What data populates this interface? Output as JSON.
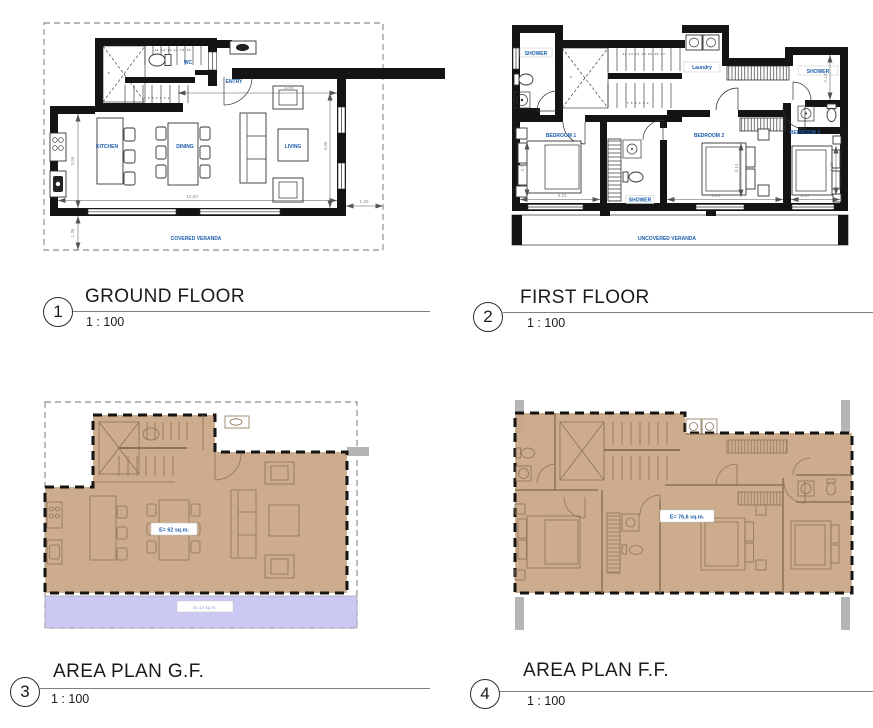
{
  "colors": {
    "label_blue": "#1A5DAB",
    "dim_gray": "#8C8C8C",
    "area_tan": "#C9A584",
    "veranda_lavender": "#CBC9F4",
    "column_gray": "#B5B5B5",
    "furniture_brown": "#8F7355"
  },
  "titles": [
    {
      "number": "1",
      "name": "GROUND FLOOR",
      "scale": "1 : 100"
    },
    {
      "number": "2",
      "name": "FIRST FLOOR",
      "scale": "1 : 100"
    },
    {
      "number": "3",
      "name": "AREA PLAN G.F.",
      "scale": "1 : 100"
    },
    {
      "number": "4",
      "name": "AREA PLAN F.F.",
      "scale": "1 : 100"
    }
  ],
  "viewports": {
    "ground_floor": {
      "labels": {
        "kitchen": "KITCHEN",
        "dining": "DINING",
        "living": "LIVING",
        "wc": "WC",
        "entry": "ENTRY",
        "veranda": "COVERED VERANDA"
      },
      "dims": {
        "entry_width": "5.95",
        "living_depth": "4.80",
        "main_width": "10.60",
        "side_offset": "1.20",
        "kitchen_depth": "3.55",
        "veranda_depth": "1.35"
      },
      "stairs": {
        "upper": "11 12 13 14 15 16",
        "lower": "7 6 5 4 3 2 1",
        "mid": "9"
      }
    },
    "first_floor": {
      "labels": {
        "shower_left": "SHOWER",
        "laundry": "Laundry",
        "shower_right": "SHOWER",
        "bedroom1": "BEDROOM 1",
        "bedroom2": "BEDROOM 2",
        "bedroom3": "BEDROOM 3",
        "shower_mid": "SHOWER",
        "veranda": "UNCOVERED VERANDA"
      },
      "dims": {
        "bedroom1_width": "3.10",
        "bedroom2_width": "3.20",
        "bedroom3_width": "3.10",
        "bedroom1_depth": "3.70",
        "bedroom2_depth": "3.10",
        "bedroom3_depth": "3.20",
        "shower_right_depth": "2.10"
      },
      "stairs": {
        "upper": "11 12 13 14 15 16 17",
        "lower": "7 6 5 4 3 2",
        "mid": "9"
      }
    },
    "area_gf": {
      "area": "E= 62 sq.m.",
      "veranda_area": "E=14 sq.m."
    },
    "area_ff": {
      "area": "E= 76,6 sq.m."
    }
  }
}
